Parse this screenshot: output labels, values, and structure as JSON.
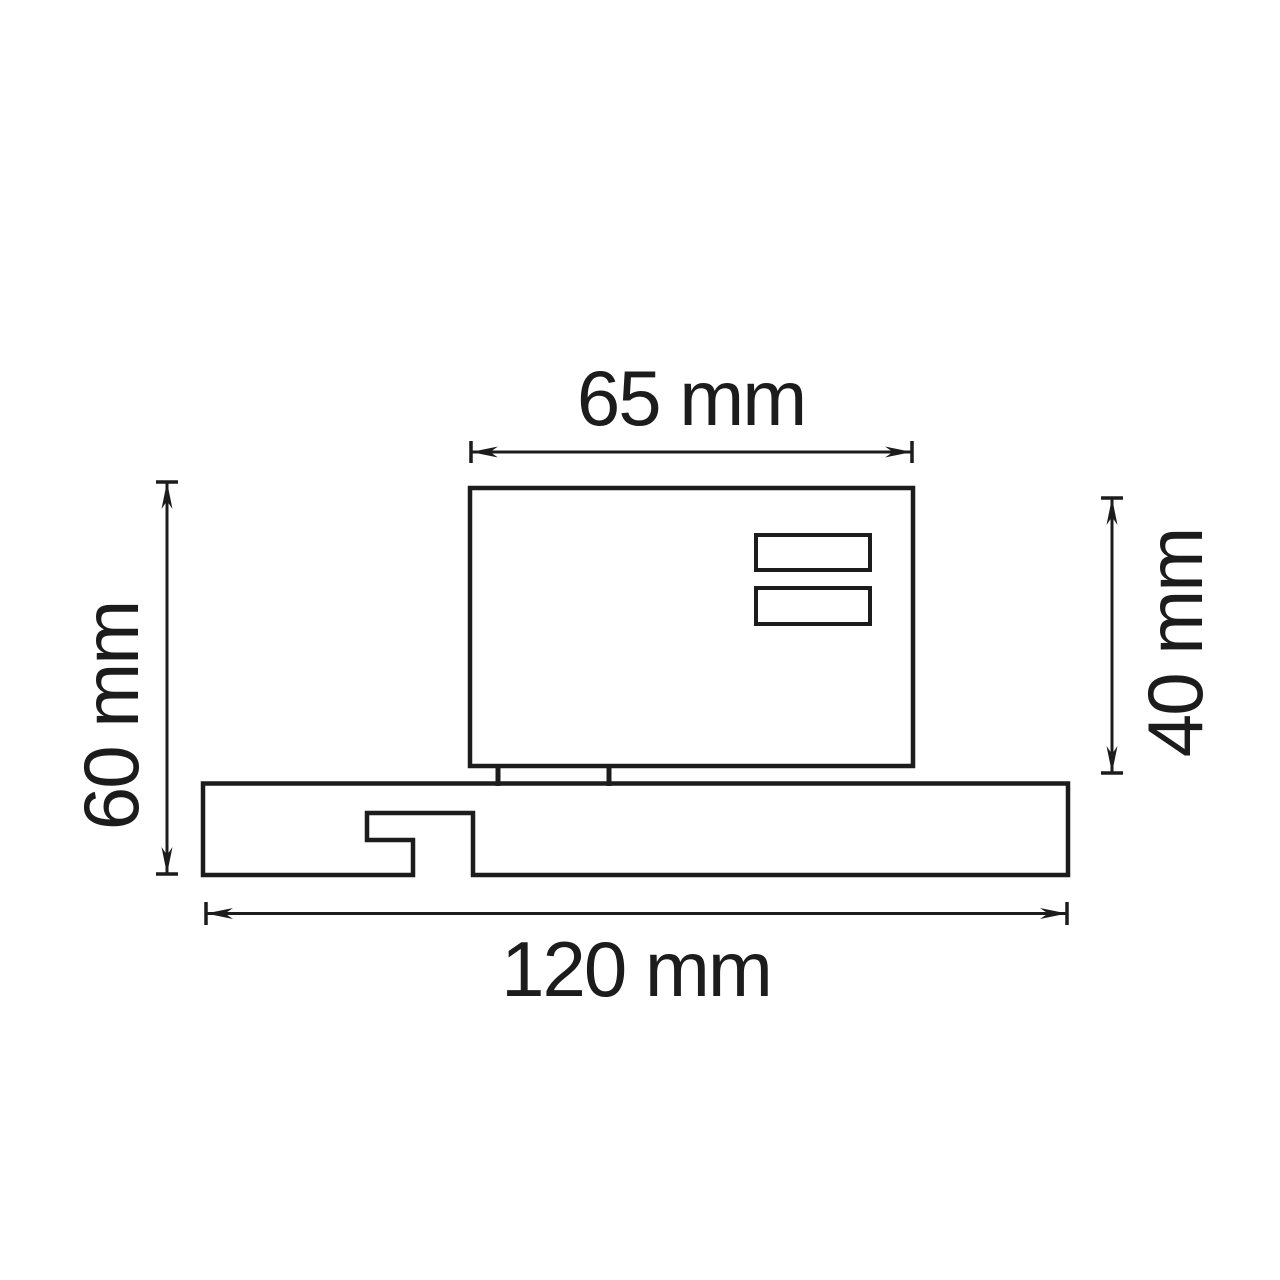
{
  "drawing": {
    "background_color": "#ffffff",
    "line_color": "#1c1c1c",
    "dimensions": {
      "top_width": {
        "label": "65 mm",
        "value": 65,
        "unit": "mm"
      },
      "left_height": {
        "label": "60 mm",
        "value": 60,
        "unit": "mm"
      },
      "right_height": {
        "label": "40 mm",
        "value": 40,
        "unit": "mm"
      },
      "bottom_width": {
        "label": "120 mm",
        "value": 120,
        "unit": "mm"
      }
    }
  }
}
